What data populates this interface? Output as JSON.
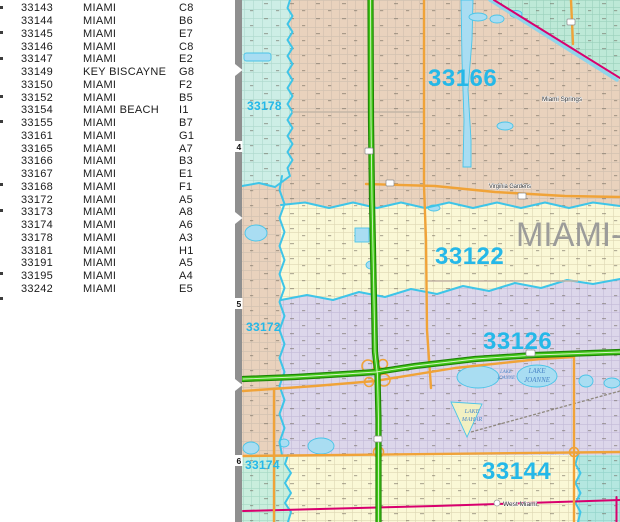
{
  "table": {
    "rows": [
      {
        "zip": "33143",
        "city": "MIAMI",
        "grid": "C8"
      },
      {
        "zip": "33144",
        "city": "MIAMI",
        "grid": "B6"
      },
      {
        "zip": "33145",
        "city": "MIAMI",
        "grid": "E7"
      },
      {
        "zip": "33146",
        "city": "MIAMI",
        "grid": "C8"
      },
      {
        "zip": "33147",
        "city": "MIAMI",
        "grid": "E2"
      },
      {
        "zip": "33149",
        "city": "KEY BISCAYNE",
        "grid": "G8"
      },
      {
        "zip": "33150",
        "city": "MIAMI",
        "grid": "F2"
      },
      {
        "zip": "33152",
        "city": "MIAMI",
        "grid": "B5"
      },
      {
        "zip": "33154",
        "city": "MIAMI BEACH",
        "grid": "I1"
      },
      {
        "zip": "33155",
        "city": "MIAMI",
        "grid": "B7"
      },
      {
        "zip": "33161",
        "city": "MIAMI",
        "grid": "G1"
      },
      {
        "zip": "33165",
        "city": "MIAMI",
        "grid": "A7"
      },
      {
        "zip": "33166",
        "city": "MIAMI",
        "grid": "B3"
      },
      {
        "zip": "33167",
        "city": "MIAMI",
        "grid": "E1"
      },
      {
        "zip": "33168",
        "city": "MIAMI",
        "grid": "F1"
      },
      {
        "zip": "33172",
        "city": "MIAMI",
        "grid": "A5"
      },
      {
        "zip": "33173",
        "city": "MIAMI",
        "grid": "A8"
      },
      {
        "zip": "33174",
        "city": "MIAMI",
        "grid": "A6"
      },
      {
        "zip": "33178",
        "city": "MIAMI",
        "grid": "A3"
      },
      {
        "zip": "33181",
        "city": "MIAMI",
        "grid": "H1"
      },
      {
        "zip": "33191",
        "city": "MIAMI",
        "grid": "A5"
      },
      {
        "zip": "33195",
        "city": "MIAMI",
        "grid": "A4"
      },
      {
        "zip": "33242",
        "city": "MIAMI",
        "grid": "E5"
      }
    ]
  },
  "map": {
    "grid_row_labels": [
      "4",
      "5",
      "6"
    ],
    "zip_labels": {
      "z33178": "33178",
      "z33166": "33166",
      "z33122": "33122",
      "z33126": "33126",
      "z33144": "33144",
      "z33172": "33172",
      "z33174": "33174"
    },
    "county_label": "MIAMI-",
    "places": {
      "miami_springs": "Miami Springs",
      "virginia_gardens": "Virginia Gardens",
      "west_miami": "West Miami"
    },
    "lakes": {
      "joanne_small": {
        "line1": "LAKE",
        "line2": "JOANNE"
      },
      "joanne": {
        "line1": "LAKE",
        "line2": "JOANNE"
      },
      "mahar": {
        "line1": "LAKE",
        "line2": "MAHAR"
      }
    },
    "colors": {
      "zip_label_cyan": "#25b8e8",
      "county_gray": "#9c9c9a",
      "highway_green": "#3fc417",
      "road_orange": "#f0a338",
      "boundary_cyan": "#3ec5e8",
      "boundary_magenta": "#d8006e",
      "water_blue": "#a9ddf2",
      "region_tan": "#e9d2bd",
      "region_yellow": "#faf8d6",
      "region_lavender": "#dcd6ea",
      "region_teal": "#bde9d7",
      "region_aqua": "#cdeee6"
    }
  }
}
